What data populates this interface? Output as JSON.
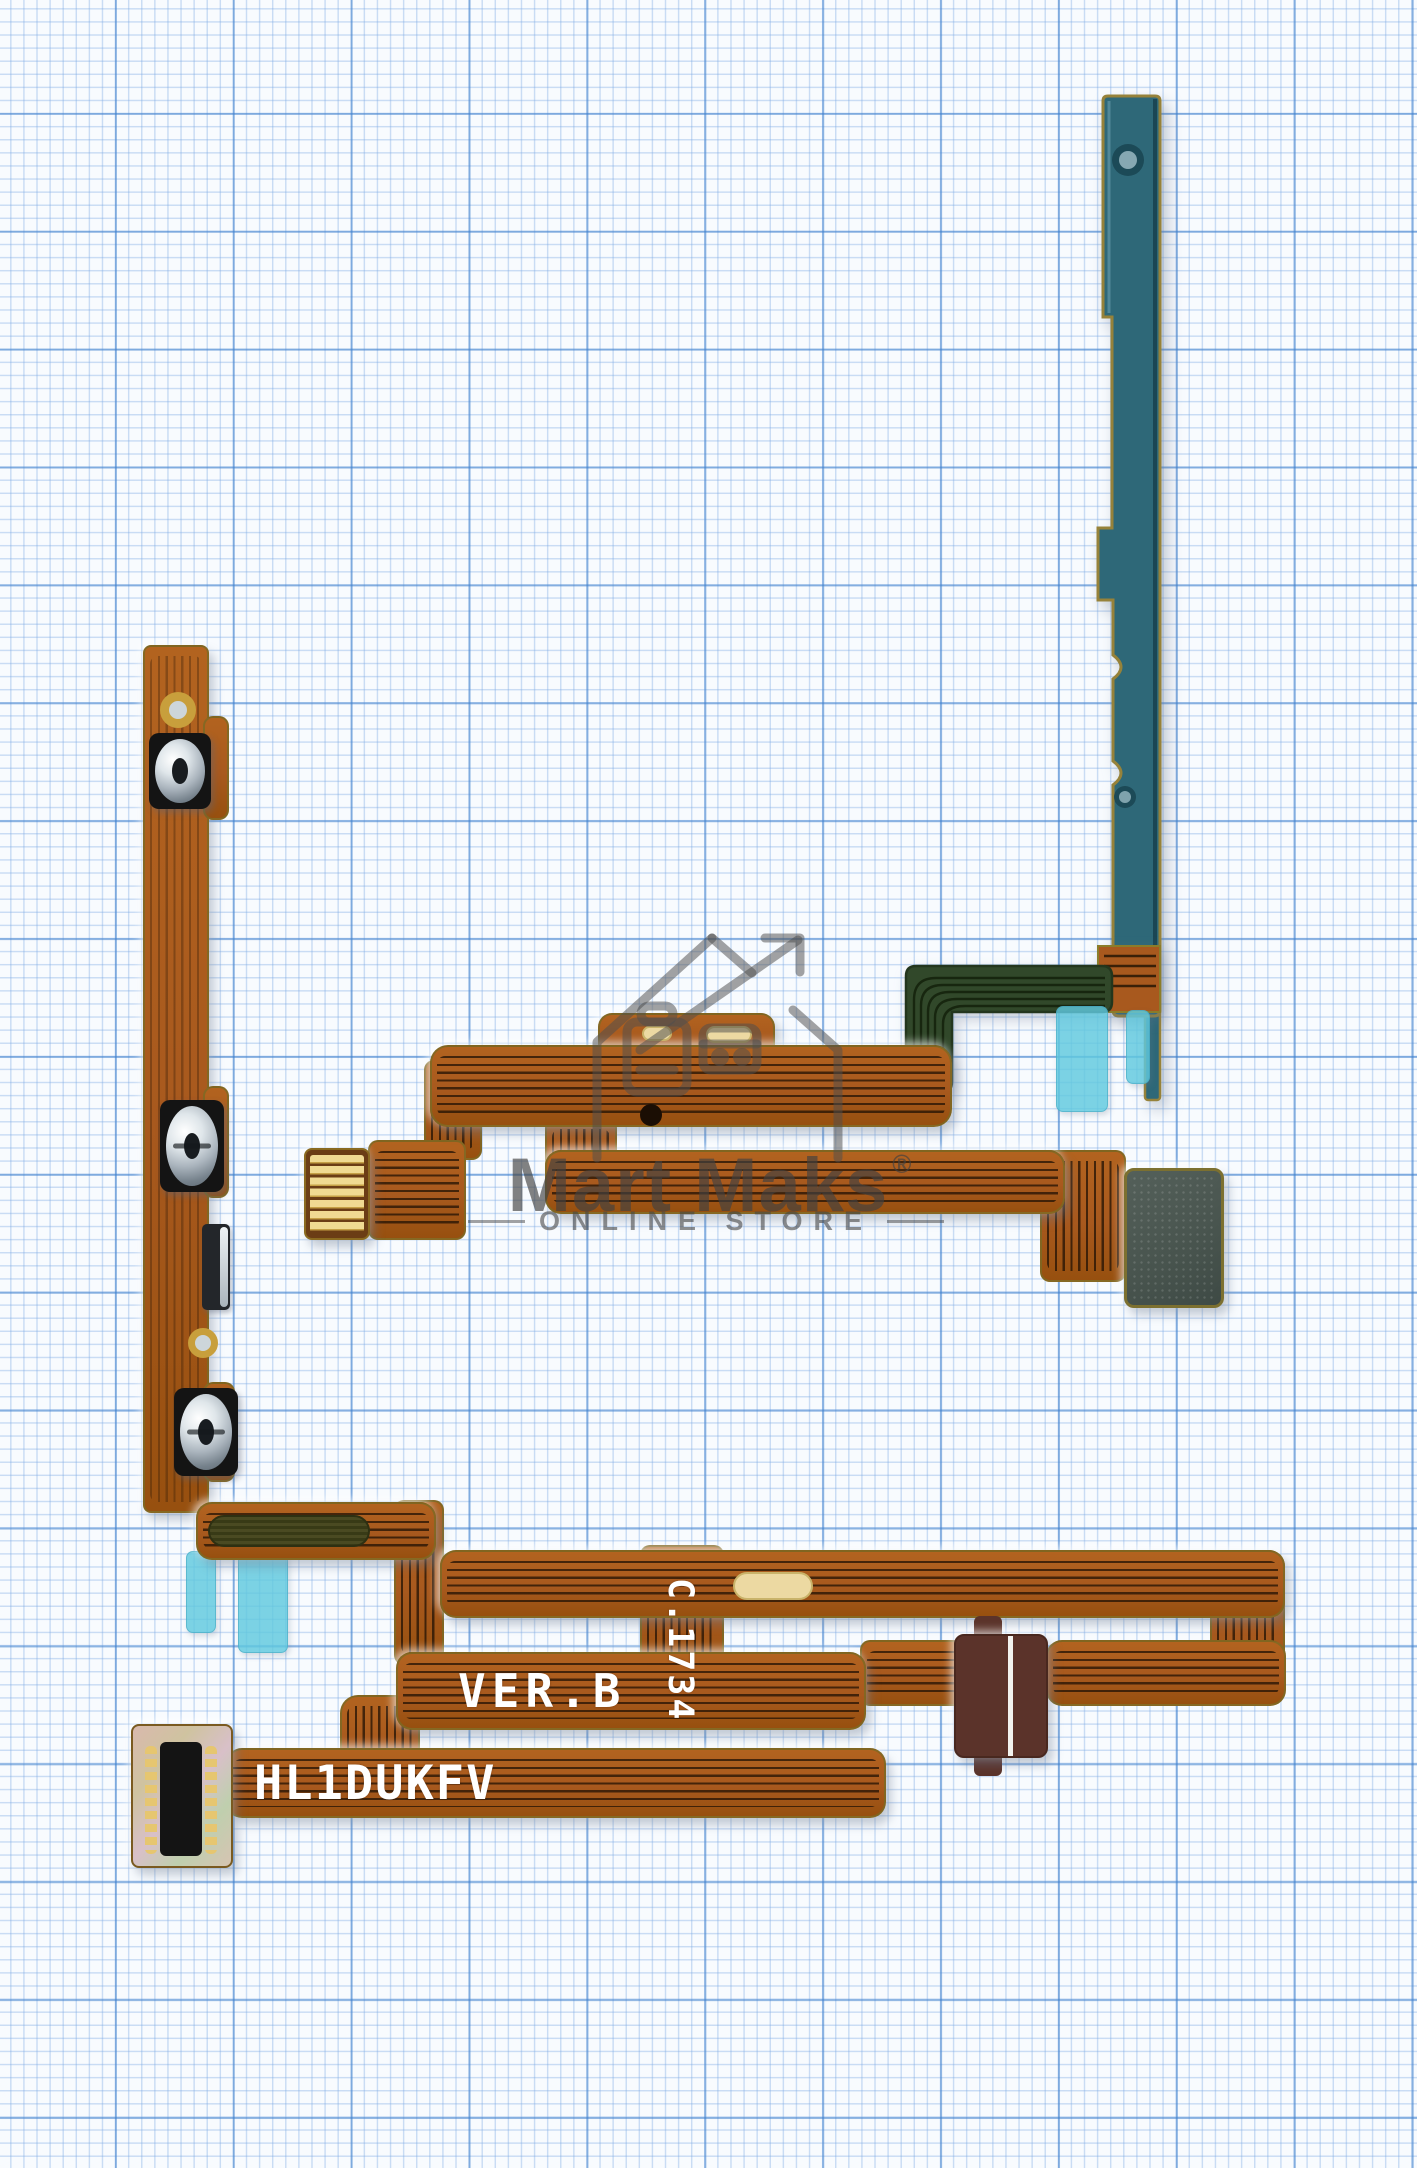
{
  "watermark": {
    "brand": "Mart Maks",
    "registered_mark": "®",
    "subtitle": "ONLINE STORE"
  },
  "flex_markings": {
    "version": "VER.B",
    "date_code": "C.1734",
    "model_code": "HL1DUKFV"
  },
  "colors": {
    "paper": "#f8fbfe",
    "grid_minor": "#aecbe9",
    "grid_major": "#4b8fd2",
    "copper_flex": "#a8591e",
    "dark_trace": "#2d1804",
    "edge_gold": "#8b7d2a",
    "bracket_teal": "#2e6878",
    "pcb_green": "#31482a",
    "tape_cyan": "#5fc8de",
    "pad_slate": "#4a564f",
    "connector_maroon": "#5b332a",
    "gold_contact": "#e3c06a",
    "watermark_gray": "#4f4f4f"
  }
}
